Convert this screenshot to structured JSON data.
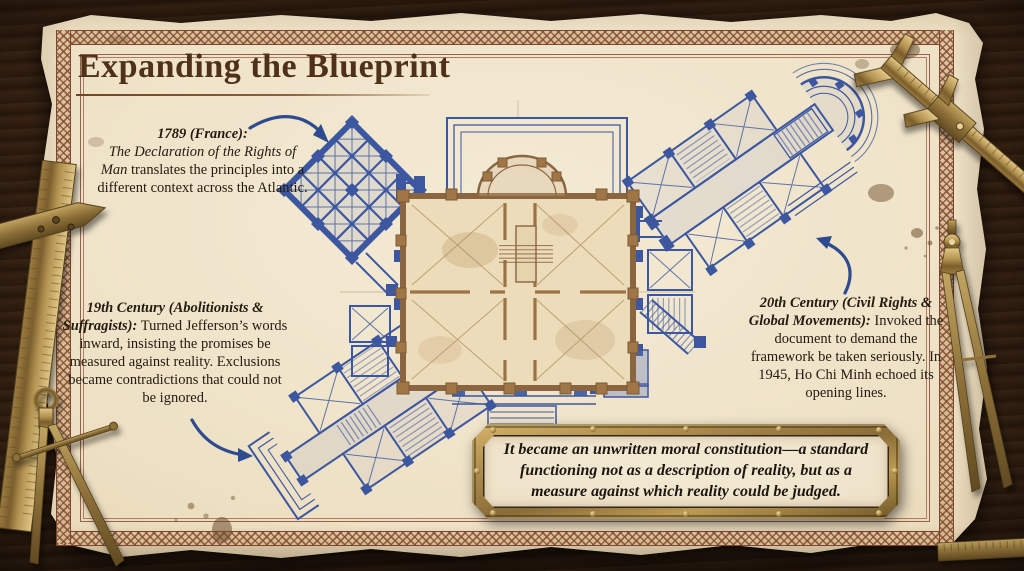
{
  "slide": {
    "title": "Expanding the Blueprint",
    "surface": "aged parchment sheet with ornamental braided border on a dark wood desk"
  },
  "annotations": [
    {
      "id": "1789-france",
      "lead": "1789 (France):",
      "work_title": "The Declaration of the Rights of Man",
      "body": "translates the principles into a different context across the Atlantic."
    },
    {
      "id": "19th-century",
      "lead": "19th Century (Abolitionists & Suffragists):",
      "body": "Turned Jefferson’s words inward, insisting the promises be measured against reality. Exclusions became contradictions that could not be ignored."
    },
    {
      "id": "20th-century",
      "lead": "20th Century (Civil Rights & Global Movements):",
      "body": "Invoked the document to demand the framework be taken seriously. In 1945, Ho Chi Minh echoed its opening lines."
    }
  ],
  "quote": {
    "text": "It became an unwritten moral constitution—a standard functioning not as a description of reality, but as a measure against which reality could be judged."
  },
  "blueprint": {
    "core_ink": "sepia",
    "extension_ink": "blueprint-blue",
    "elements": [
      "central-hall-plan",
      "northwest-lattice-pavilion",
      "northeast-wing-with-apse",
      "southwest-wing",
      "south-colonnade-with-steps"
    ]
  },
  "tools": [
    "vernier-caliper",
    "t-square-ruler",
    "proportional-dividers",
    "drafting-compass",
    "ruler-fragment"
  ],
  "colors": {
    "wood": "#3a2315",
    "parchment": "#eee1c5",
    "border_ink": "#8b4f3a",
    "title_ink": "#4f3018",
    "body_ink": "#231b10",
    "blueprint_blue": "#3c57a0",
    "sepia_ink": "#8a6540",
    "brass": "#b2914f"
  }
}
